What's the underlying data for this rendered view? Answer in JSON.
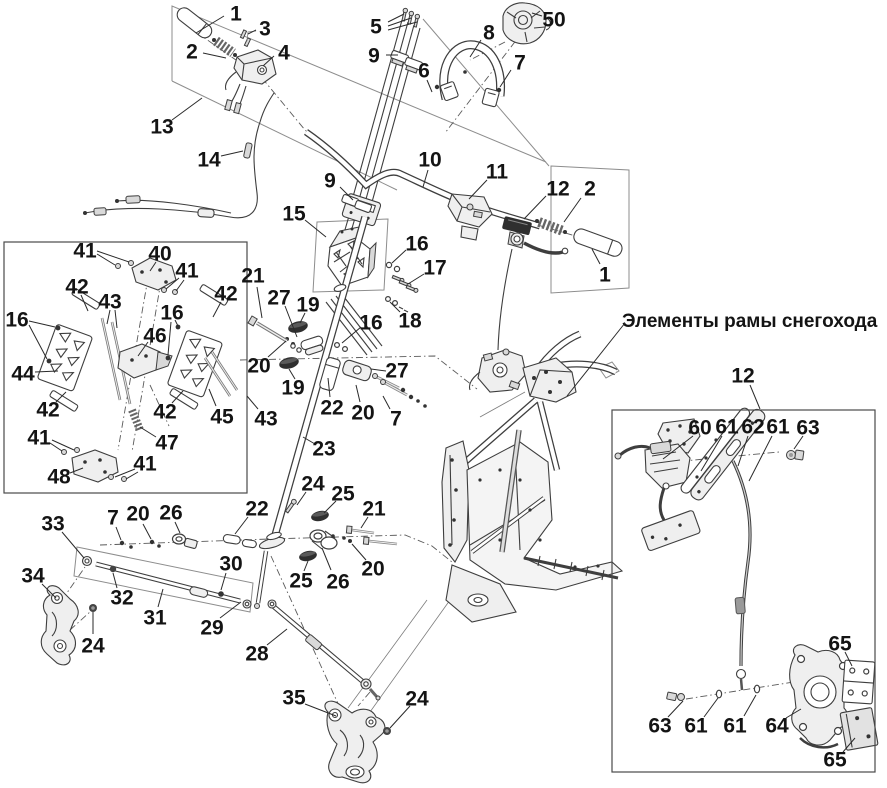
{
  "title": {
    "text": "Элементы рамы снегохода"
  },
  "colors": {
    "background": "#ffffff",
    "line": "#3e3e3e",
    "label": "#141414",
    "construction": "#8d8d8d"
  },
  "boxes": {
    "left": {
      "x": 4,
      "y": 242,
      "w": 243,
      "h": 251
    },
    "right": {
      "x": 612,
      "y": 410,
      "w": 263,
      "h": 362
    }
  },
  "title_leader": [
    625,
    323,
    567,
    396
  ],
  "callouts": [
    {
      "t": "1",
      "x": 236,
      "y": 13,
      "l": [
        [
          224,
          16,
          196,
          33
        ]
      ]
    },
    {
      "t": "2",
      "x": 192,
      "y": 51,
      "l": [
        [
          203,
          53,
          226,
          58
        ]
      ]
    },
    {
      "t": "3",
      "x": 265,
      "y": 28,
      "l": [
        [
          256,
          30,
          248,
          34
        ]
      ]
    },
    {
      "t": "4",
      "x": 284,
      "y": 52,
      "l": [
        [
          274,
          56,
          263,
          66
        ]
      ]
    },
    {
      "t": "13",
      "x": 162,
      "y": 126,
      "l": [
        [
          172,
          120,
          202,
          98
        ]
      ]
    },
    {
      "t": "14",
      "x": 209,
      "y": 159,
      "l": [
        [
          221,
          156,
          243,
          151
        ]
      ]
    },
    {
      "t": "5",
      "x": 376,
      "y": 26,
      "l": [
        [
          388,
          22,
          404,
          14
        ],
        [
          388,
          26,
          411,
          18
        ],
        [
          388,
          30,
          417,
          22
        ]
      ]
    },
    {
      "t": "9",
      "x": 374,
      "y": 55,
      "l": [
        [
          386,
          55,
          398,
          55
        ]
      ]
    },
    {
      "t": "6",
      "x": 424,
      "y": 70,
      "l": [
        [
          427,
          80,
          432,
          92
        ]
      ]
    },
    {
      "t": "8",
      "x": 489,
      "y": 32,
      "l": [
        [
          481,
          40,
          470,
          57
        ]
      ]
    },
    {
      "t": "50",
      "x": 554,
      "y": 19,
      "l": [
        [
          542,
          16,
          532,
          13
        ]
      ]
    },
    {
      "t": "7",
      "x": 520,
      "y": 62,
      "l": [
        [
          511,
          70,
          500,
          87
        ]
      ]
    },
    {
      "t": "9",
      "x": 330,
      "y": 180,
      "l": [
        [
          340,
          187,
          353,
          200
        ]
      ]
    },
    {
      "t": "10",
      "x": 430,
      "y": 159,
      "l": [
        [
          428,
          170,
          423,
          187
        ]
      ]
    },
    {
      "t": "11",
      "x": 497,
      "y": 171,
      "l": [
        [
          487,
          180,
          469,
          199
        ]
      ]
    },
    {
      "t": "12",
      "x": 558,
      "y": 188,
      "l": [
        [
          546,
          196,
          524,
          219
        ]
      ]
    },
    {
      "t": "2",
      "x": 590,
      "y": 188,
      "l": [
        [
          581,
          198,
          564,
          222
        ]
      ]
    },
    {
      "t": "1",
      "x": 605,
      "y": 274,
      "l": [
        [
          600,
          264,
          592,
          249
        ]
      ]
    },
    {
      "t": "15",
      "x": 294,
      "y": 213,
      "l": [
        [
          305,
          220,
          326,
          237
        ]
      ]
    },
    {
      "t": "16",
      "x": 417,
      "y": 243,
      "l": [
        [
          406,
          250,
          392,
          263
        ]
      ]
    },
    {
      "t": "17",
      "x": 435,
      "y": 267,
      "l": [
        [
          424,
          274,
          408,
          284
        ]
      ]
    },
    {
      "t": "18",
      "x": 410,
      "y": 320,
      "l": [
        [
          400,
          312,
          390,
          302
        ]
      ]
    },
    {
      "t": "21",
      "x": 253,
      "y": 275,
      "l": [
        [
          257,
          287,
          262,
          318
        ]
      ]
    },
    {
      "t": "27",
      "x": 279,
      "y": 297,
      "l": [
        [
          285,
          306,
          297,
          337
        ]
      ]
    },
    {
      "t": "19",
      "x": 308,
      "y": 304,
      "l": [
        [
          305,
          313,
          300,
          323
        ]
      ]
    },
    {
      "t": "16",
      "x": 371,
      "y": 322,
      "l": [
        [
          361,
          327,
          342,
          343
        ]
      ]
    },
    {
      "t": "20",
      "x": 259,
      "y": 365,
      "l": [
        [
          268,
          357,
          286,
          341
        ]
      ]
    },
    {
      "t": "19",
      "x": 293,
      "y": 387,
      "l": [
        [
          295,
          379,
          289,
          369
        ]
      ]
    },
    {
      "t": "22",
      "x": 332,
      "y": 407,
      "l": [
        [
          330,
          397,
          328,
          378
        ]
      ]
    },
    {
      "t": "20",
      "x": 363,
      "y": 412,
      "l": [
        [
          360,
          402,
          356,
          385
        ]
      ]
    },
    {
      "t": "27",
      "x": 397,
      "y": 370,
      "l": [
        [
          386,
          371,
          371,
          369
        ]
      ]
    },
    {
      "t": "7",
      "x": 396,
      "y": 418,
      "l": [
        [
          390,
          409,
          383,
          396
        ]
      ]
    },
    {
      "t": "43",
      "x": 266,
      "y": 418,
      "l": [
        [
          258,
          409,
          247,
          396
        ]
      ]
    },
    {
      "t": "23",
      "x": 324,
      "y": 448,
      "l": [
        [
          315,
          444,
          303,
          437
        ]
      ]
    },
    {
      "t": "41",
      "x": 85,
      "y": 250,
      "l": [
        [
          97,
          254,
          115,
          265
        ],
        [
          97,
          251,
          129,
          262
        ]
      ]
    },
    {
      "t": "40",
      "x": 160,
      "y": 253,
      "l": [
        [
          156,
          262,
          150,
          271
        ]
      ]
    },
    {
      "t": "41",
      "x": 187,
      "y": 270,
      "l": [
        [
          179,
          278,
          166,
          289
        ],
        [
          184,
          280,
          176,
          291
        ]
      ]
    },
    {
      "t": "42",
      "x": 77,
      "y": 286,
      "l": [
        [
          81,
          295,
          88,
          311
        ]
      ]
    },
    {
      "t": "43",
      "x": 110,
      "y": 301,
      "l": [
        [
          110,
          310,
          107,
          324
        ],
        [
          115,
          310,
          117,
          328
        ]
      ]
    },
    {
      "t": "16",
      "x": 17,
      "y": 319,
      "l": [
        [
          29,
          321,
          55,
          327
        ],
        [
          29,
          325,
          47,
          359
        ]
      ]
    },
    {
      "t": "16",
      "x": 172,
      "y": 312,
      "l": [
        [
          175,
          320,
          178,
          326
        ],
        [
          171,
          322,
          168,
          355
        ]
      ]
    },
    {
      "t": "42",
      "x": 226,
      "y": 293,
      "l": [
        [
          221,
          302,
          213,
          317
        ]
      ]
    },
    {
      "t": "46",
      "x": 155,
      "y": 335,
      "l": [
        [
          148,
          342,
          138,
          356
        ]
      ]
    },
    {
      "t": "44",
      "x": 23,
      "y": 373,
      "l": [
        [
          35,
          372,
          58,
          371
        ]
      ]
    },
    {
      "t": "42",
      "x": 48,
      "y": 409,
      "l": [
        [
          56,
          402,
          66,
          392
        ]
      ]
    },
    {
      "t": "42",
      "x": 165,
      "y": 411,
      "l": [
        [
          172,
          403,
          183,
          391
        ]
      ]
    },
    {
      "t": "45",
      "x": 222,
      "y": 416,
      "l": [
        [
          216,
          406,
          209,
          389
        ]
      ]
    },
    {
      "t": "47",
      "x": 167,
      "y": 442,
      "l": [
        [
          156,
          437,
          140,
          427
        ]
      ]
    },
    {
      "t": "41",
      "x": 39,
      "y": 437,
      "l": [
        [
          50,
          443,
          62,
          451
        ],
        [
          52,
          440,
          74,
          450
        ]
      ]
    },
    {
      "t": "48",
      "x": 59,
      "y": 476,
      "l": [
        [
          70,
          473,
          83,
          468
        ]
      ]
    },
    {
      "t": "41",
      "x": 145,
      "y": 463,
      "l": [
        [
          135,
          469,
          115,
          477
        ],
        [
          138,
          472,
          126,
          479
        ]
      ]
    },
    {
      "t": "33",
      "x": 53,
      "y": 523,
      "l": [
        [
          62,
          532,
          84,
          558
        ]
      ]
    },
    {
      "t": "7",
      "x": 113,
      "y": 517,
      "l": [
        [
          116,
          527,
          121,
          540
        ]
      ]
    },
    {
      "t": "20",
      "x": 138,
      "y": 513,
      "l": [
        [
          143,
          524,
          151,
          539
        ]
      ]
    },
    {
      "t": "26",
      "x": 171,
      "y": 512,
      "l": [
        [
          175,
          522,
          180,
          533
        ]
      ]
    },
    {
      "t": "22",
      "x": 257,
      "y": 508,
      "l": [
        [
          248,
          517,
          235,
          534
        ]
      ]
    },
    {
      "t": "34",
      "x": 33,
      "y": 575,
      "l": [
        [
          42,
          584,
          56,
          598
        ]
      ]
    },
    {
      "t": "32",
      "x": 122,
      "y": 597,
      "l": [
        [
          117,
          588,
          113,
          573
        ]
      ]
    },
    {
      "t": "31",
      "x": 155,
      "y": 617,
      "l": [
        [
          158,
          607,
          163,
          589
        ]
      ]
    },
    {
      "t": "30",
      "x": 231,
      "y": 563,
      "l": [
        [
          226,
          573,
          221,
          590
        ]
      ]
    },
    {
      "t": "29",
      "x": 212,
      "y": 627,
      "l": [
        [
          220,
          618,
          241,
          602
        ]
      ]
    },
    {
      "t": "24",
      "x": 93,
      "y": 645,
      "l": [
        [
          93,
          634,
          93,
          612
        ]
      ]
    },
    {
      "t": "28",
      "x": 257,
      "y": 653,
      "l": [
        [
          267,
          645,
          287,
          629
        ]
      ]
    },
    {
      "t": "35",
      "x": 294,
      "y": 697,
      "l": [
        [
          305,
          704,
          336,
          716
        ]
      ]
    },
    {
      "t": "24",
      "x": 417,
      "y": 698,
      "l": [
        [
          410,
          706,
          390,
          728
        ]
      ]
    },
    {
      "t": "24",
      "x": 313,
      "y": 483,
      "l": [
        [
          306,
          492,
          297,
          505
        ]
      ]
    },
    {
      "t": "25",
      "x": 343,
      "y": 493,
      "l": [
        [
          336,
          501,
          324,
          513
        ]
      ]
    },
    {
      "t": "21",
      "x": 374,
      "y": 508,
      "l": [
        [
          368,
          517,
          361,
          528
        ]
      ]
    },
    {
      "t": "20",
      "x": 373,
      "y": 568,
      "l": [
        [
          366,
          560,
          352,
          544
        ]
      ]
    },
    {
      "t": "25",
      "x": 301,
      "y": 580,
      "l": [
        [
          304,
          571,
          308,
          561
        ]
      ]
    },
    {
      "t": "26",
      "x": 338,
      "y": 581,
      "l": [
        [
          331,
          570,
          322,
          548
        ]
      ]
    },
    {
      "t": "12",
      "x": 743,
      "y": 375,
      "l": [
        [
          750,
          385,
          760,
          409
        ]
      ]
    },
    {
      "t": "60",
      "x": 700,
      "y": 427,
      "l": [
        [
          693,
          436,
          663,
          459
        ]
      ]
    },
    {
      "t": "61",
      "x": 727,
      "y": 426,
      "l": [
        [
          722,
          436,
          701,
          471
        ]
      ]
    },
    {
      "t": "62",
      "x": 753,
      "y": 426,
      "l": [
        [
          748,
          436,
          738,
          466
        ]
      ]
    },
    {
      "t": "61",
      "x": 778,
      "y": 426,
      "l": [
        [
          772,
          436,
          749,
          481
        ]
      ]
    },
    {
      "t": "63",
      "x": 808,
      "y": 427,
      "l": [
        [
          803,
          436,
          794,
          449
        ]
      ]
    },
    {
      "t": "65",
      "x": 840,
      "y": 643,
      "l": [
        [
          845,
          652,
          852,
          666
        ]
      ]
    },
    {
      "t": "63",
      "x": 660,
      "y": 725,
      "l": [
        [
          668,
          717,
          683,
          701
        ]
      ]
    },
    {
      "t": "61",
      "x": 696,
      "y": 725,
      "l": [
        [
          704,
          717,
          718,
          698
        ]
      ]
    },
    {
      "t": "61",
      "x": 735,
      "y": 725,
      "l": [
        [
          744,
          716,
          756,
          695
        ]
      ]
    },
    {
      "t": "64",
      "x": 777,
      "y": 725,
      "l": [
        [
          786,
          718,
          801,
          709
        ]
      ]
    },
    {
      "t": "65",
      "x": 835,
      "y": 759,
      "l": [
        [
          843,
          752,
          855,
          738
        ]
      ]
    }
  ]
}
